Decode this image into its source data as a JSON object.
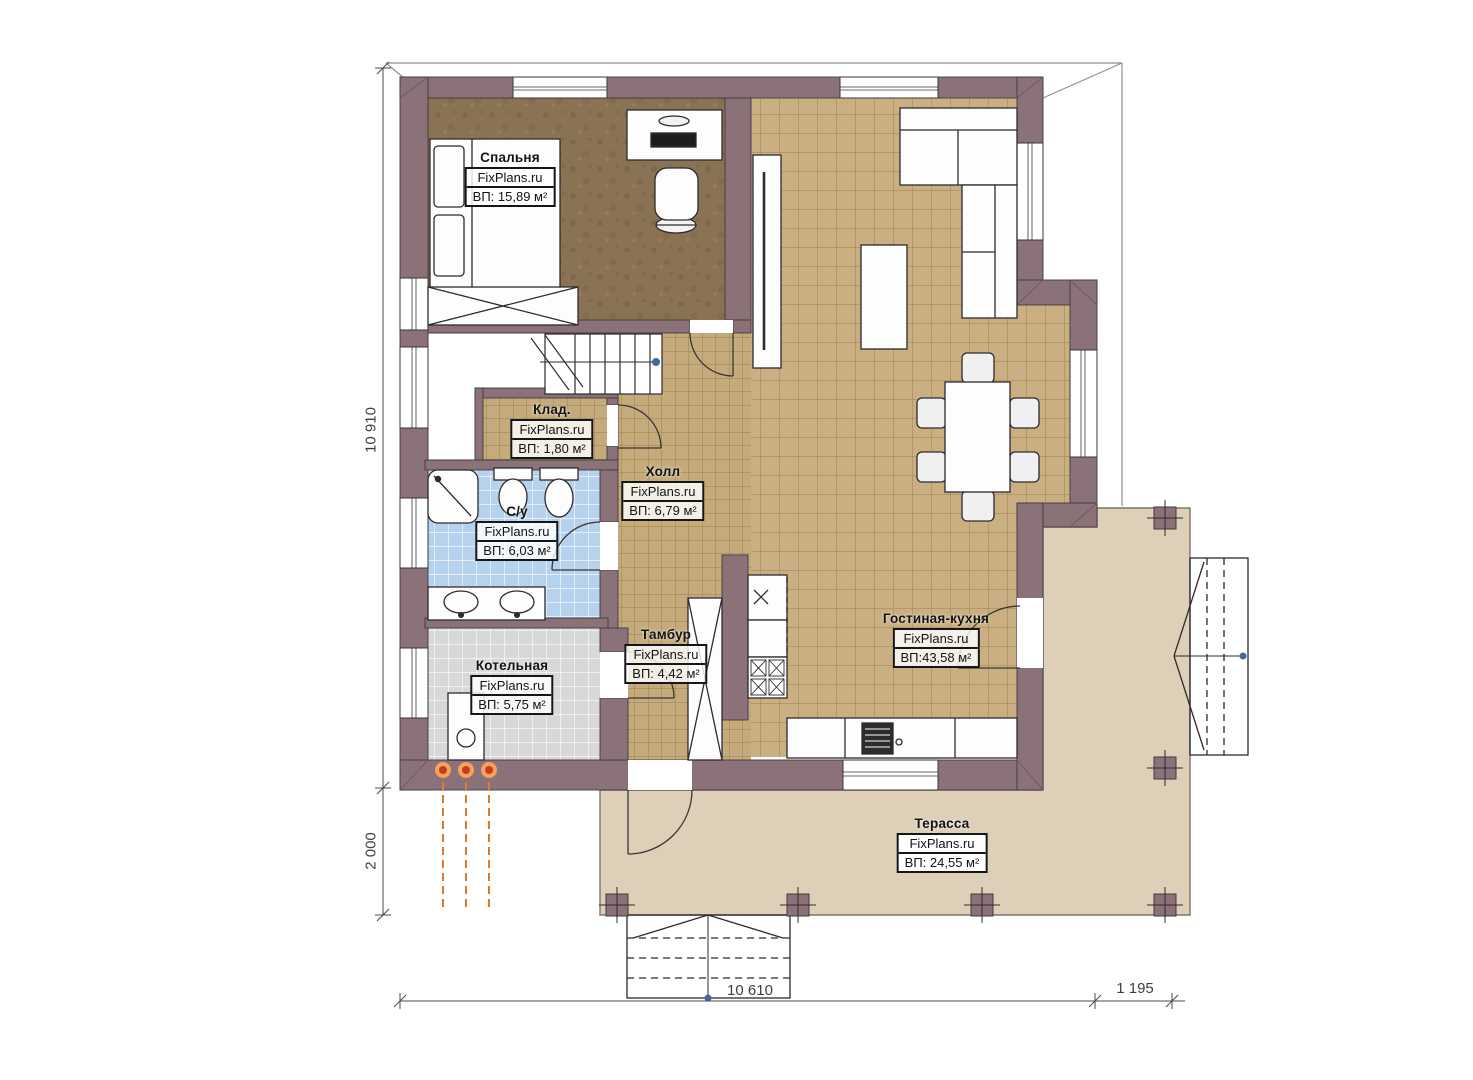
{
  "title": "План первого этажа",
  "watermark": "FixPlans.ru",
  "rooms": [
    {
      "id": "bedroom",
      "name": "Спальня",
      "watermark": "FixPlans.ru",
      "area": "ВП: 15,89 м²"
    },
    {
      "id": "storage",
      "name": "Клад.",
      "watermark": "FixPlans.ru",
      "area": "ВП: 1,80 м²"
    },
    {
      "id": "bathroom",
      "name": "С/у",
      "watermark": "FixPlans.ru",
      "area": "ВП: 6,03 м²"
    },
    {
      "id": "hall",
      "name": "Холл",
      "watermark": "FixPlans.ru",
      "area": "ВП: 6,79 м²"
    },
    {
      "id": "boiler",
      "name": "Котельная",
      "watermark": "FixPlans.ru",
      "area": "ВП: 5,75 м²"
    },
    {
      "id": "vestibule",
      "name": "Тамбур",
      "watermark": "FixPlans.ru",
      "area": "ВП: 4,42 м²"
    },
    {
      "id": "living",
      "name": "Гостиная-кухня",
      "watermark": "FixPlans.ru",
      "area": "ВП:43,58 м²"
    },
    {
      "id": "terrace",
      "name": "Терасса",
      "watermark": "FixPlans.ru",
      "area": "ВП: 24,55 м²"
    }
  ],
  "dimensions": {
    "height_total": "10 910",
    "height_terrace": "2 000",
    "width_house": "10 610",
    "width_side": "1 195"
  },
  "colors": {
    "wall": "#8a7278",
    "tile_wood": "#c9af81",
    "tile_blue": "#b7d2ec",
    "tile_gray": "#d8d8d8",
    "bedroom_floor": "#8a7355",
    "terrace": "#ddcfb8",
    "pipe_orange": "#e07a28",
    "marker_blue": "#44699d"
  }
}
